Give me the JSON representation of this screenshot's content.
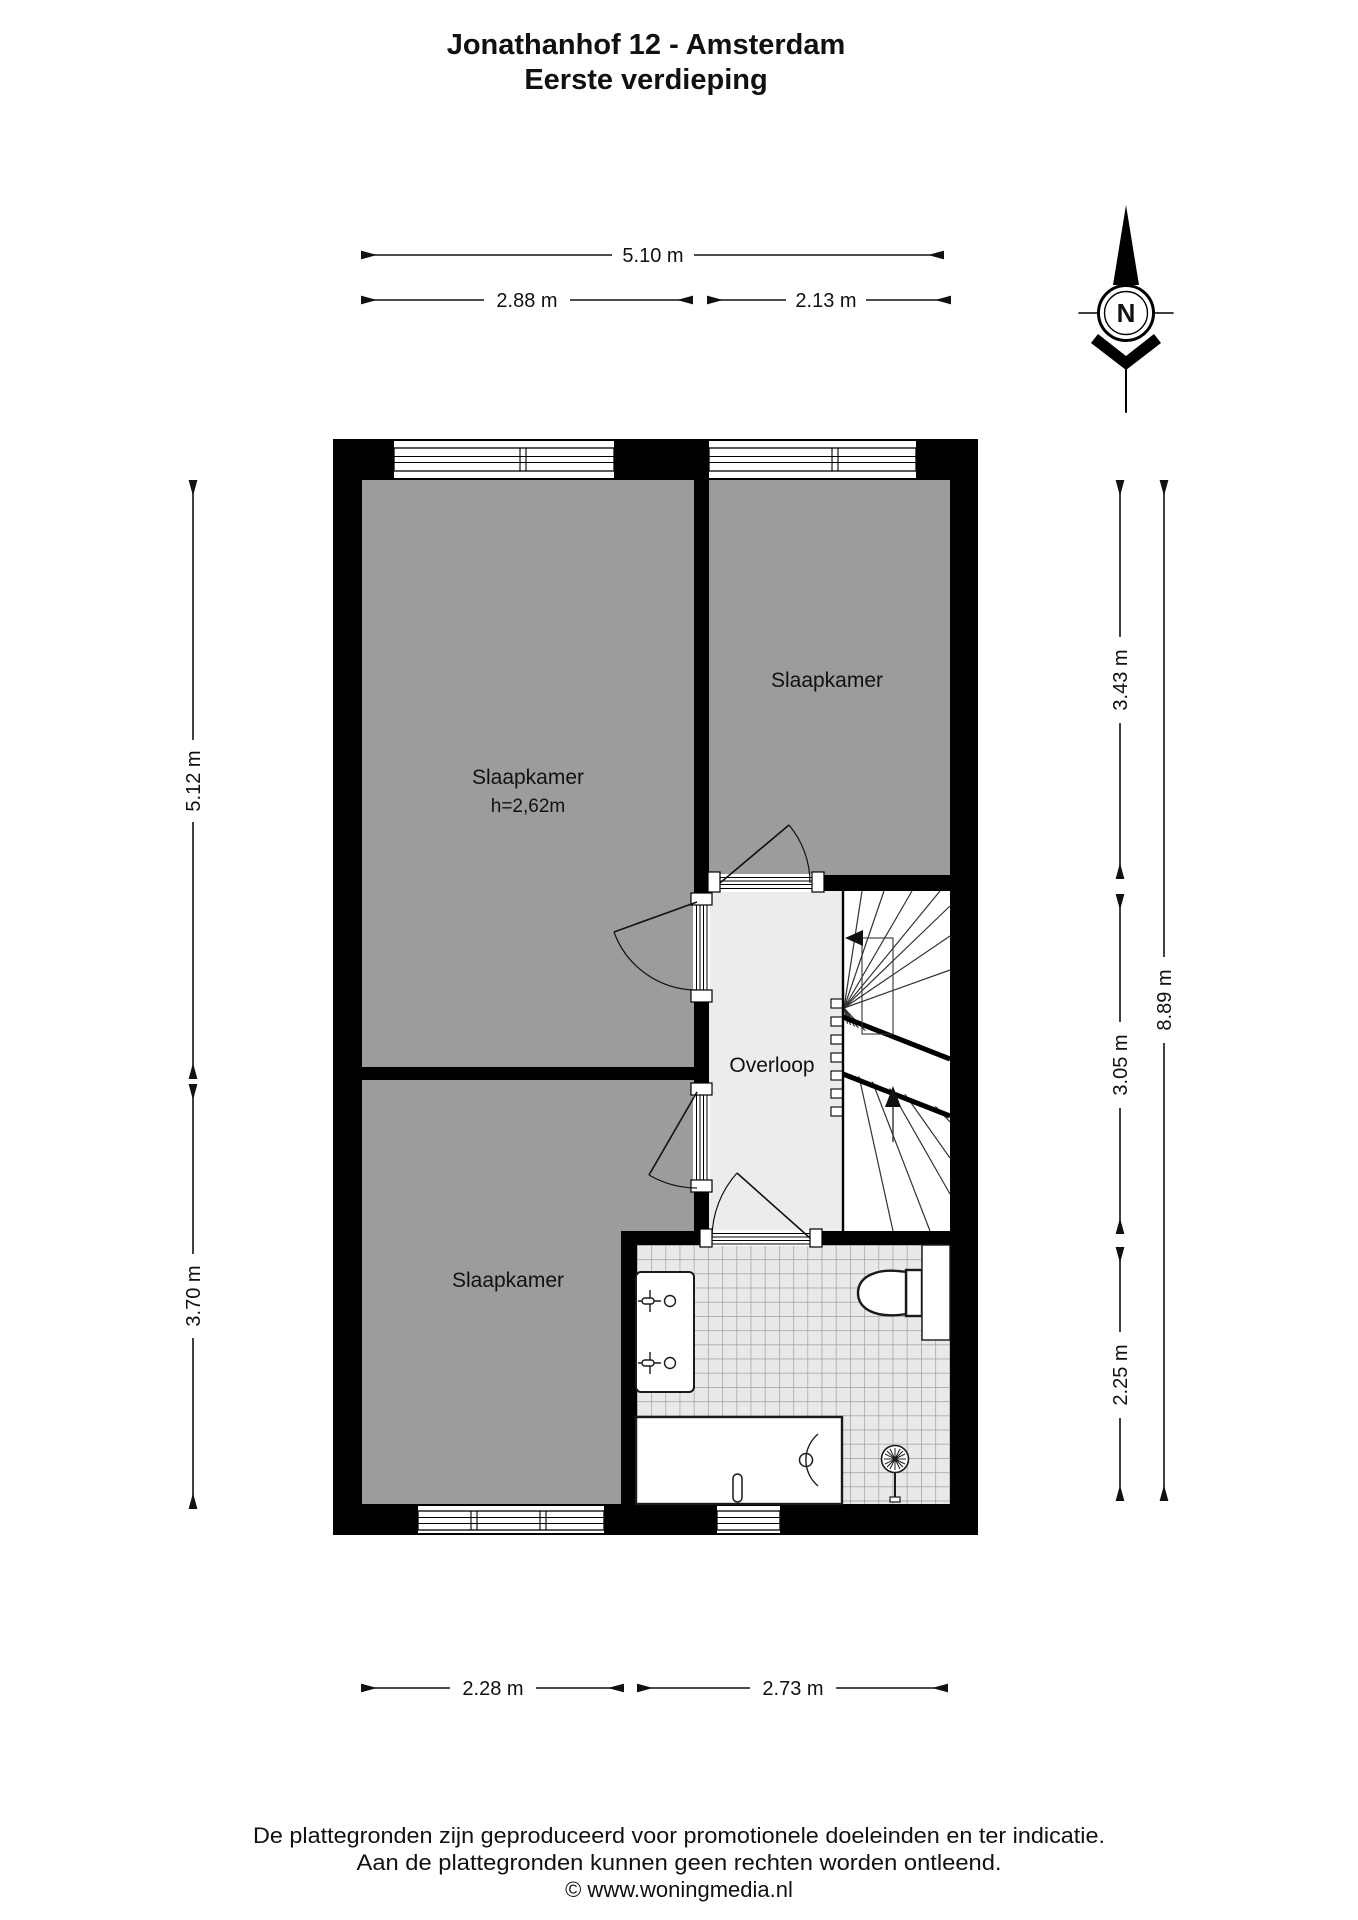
{
  "title": {
    "line1": "Jonathanhof 12 - Amsterdam",
    "line2": "Eerste verdieping"
  },
  "compass": {
    "north_label": "N"
  },
  "rooms": {
    "bedroom_large": {
      "label": "Slaapkamer",
      "height_note": "h=2,62m"
    },
    "bedroom_right": {
      "label": "Slaapkamer"
    },
    "bedroom_bottom": {
      "label": "Slaapkamer"
    },
    "landing": {
      "label": "Overloop"
    }
  },
  "dimensions": {
    "top_total": "5.10 m",
    "top_left": "2.88 m",
    "top_right": "2.13 m",
    "left_upper": "5.12 m",
    "left_lower": "3.70 m",
    "right_upper": "3.43 m",
    "right_middle": "3.05 m",
    "right_lower": "2.25 m",
    "right_total": "8.89 m",
    "bottom_left": "2.28 m",
    "bottom_right": "2.73 m"
  },
  "footer": {
    "line1": "De plattegronden zijn geproduceerd voor promotionele doeleinden en ter indicatie.",
    "line2": "Aan de plattegronden kunnen geen rechten worden ontleend.",
    "line3": "© www.woningmedia.nl"
  },
  "colors": {
    "wall": "#000000",
    "room_fill": "#9c9c9c",
    "landing_fill": "#ececec",
    "stair_fill": "#ffffff",
    "tile_fill": "#e9e9e9",
    "tile_line": "#9f9f9f",
    "line": "#1a1a1a"
  }
}
